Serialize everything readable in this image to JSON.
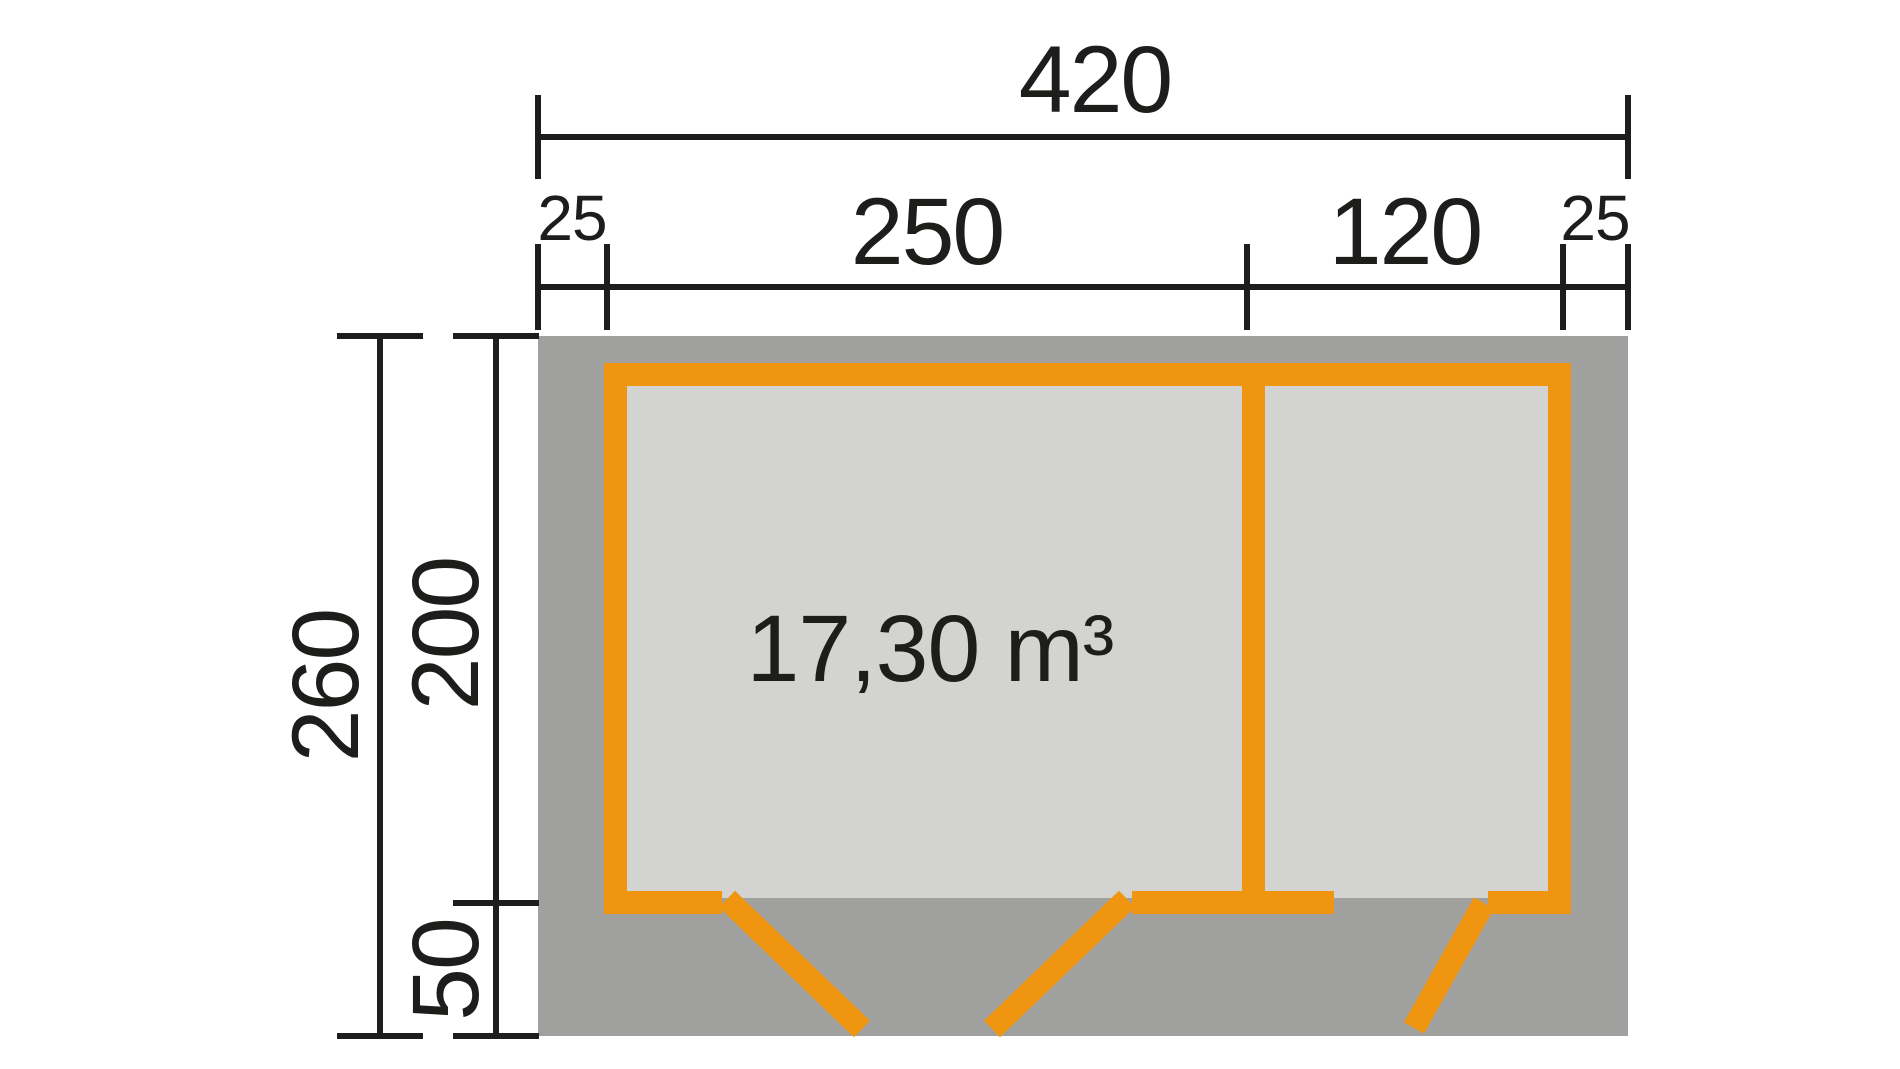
{
  "colors": {
    "wall_orange": "#EF950F",
    "roof_gray": "#A0A09F",
    "interior_gray": "#D3D3D2",
    "line_black": "#1D1D1B",
    "background": "#FFFFFF"
  },
  "dimensions": {
    "total_width": "420",
    "left_overhang": "25",
    "main_room_width": "250",
    "side_room_width": "120",
    "right_overhang": "25",
    "total_depth": "260",
    "room_depth": "200",
    "porch_depth": "50"
  },
  "interior": {
    "volume": "17,30 m³"
  }
}
